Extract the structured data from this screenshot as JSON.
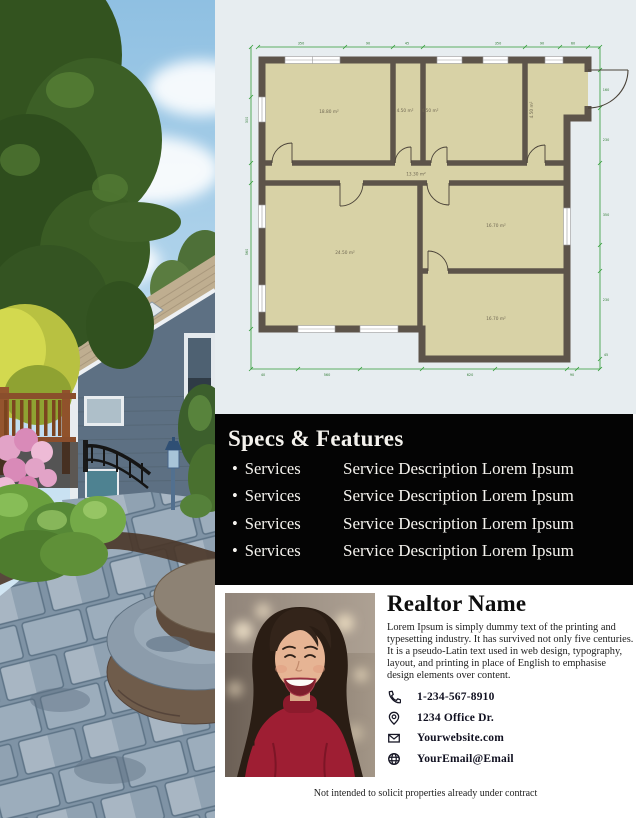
{
  "photo": {
    "description": "house exterior with evergreen tree, blue siding, deck, flower beds and stone paver walkway"
  },
  "floorplan": {
    "rooms": [
      {
        "id": "room-top-left",
        "label": "18.80 m²"
      },
      {
        "id": "room-hall-small",
        "label": "4.50 m²"
      },
      {
        "id": "room-top-middle",
        "label": "4.50 m²"
      },
      {
        "id": "room-entry",
        "label": "4.50 m²"
      },
      {
        "id": "corridor",
        "label": "13.30 m²"
      },
      {
        "id": "room-bottom-left",
        "label": "24.50 m²"
      },
      {
        "id": "room-middle-right",
        "label": "16.70 m²"
      },
      {
        "id": "room-bottom-right",
        "label": "16.70 m²"
      }
    ],
    "dims": {
      "top": [
        "350",
        "90",
        "45",
        "350",
        "90",
        "60"
      ],
      "left": [
        "300",
        "560"
      ],
      "right": [
        "160",
        "230",
        "350",
        "230",
        "45"
      ],
      "bottom": [
        "40",
        "560",
        "620",
        "90"
      ]
    },
    "colors": {
      "wall": "#5d544a",
      "room_fill": "#d8d2a6",
      "dimension_line": "#2f9b35",
      "background": "#e7edf0"
    }
  },
  "specs": {
    "title": "Specs & Features",
    "rows": [
      {
        "bullet": "•",
        "service": "Services",
        "description": "Service Description Lorem Ipsum"
      },
      {
        "bullet": "•",
        "service": "Services",
        "description": "Service Description Lorem Ipsum"
      },
      {
        "bullet": "•",
        "service": "Services",
        "description": "Service Description Lorem Ipsum"
      },
      {
        "bullet": "•",
        "service": "Services",
        "description": "Service Description Lorem Ipsum"
      }
    ],
    "colors": {
      "background": "#040404",
      "text": "#f5f3ee"
    }
  },
  "realtor": {
    "name": "Realtor Name",
    "bio": "Lorem Ipsum is simply dummy text of the printing and typesetting industry. It has survived not only five centuries. It is a pseudo-Latin text used in web design, typography, layout, and printing in place of English to emphasise design elements over content.",
    "contacts": [
      {
        "icon": "phone-icon",
        "value": "1-234-567-8910"
      },
      {
        "icon": "location-pin-icon",
        "value": "1234 Office Dr."
      },
      {
        "icon": "envelope-icon",
        "value": "Yourwebsite.com"
      },
      {
        "icon": "globe-icon",
        "value": "YourEmail@Email"
      }
    ]
  },
  "footer": {
    "disclaimer": "Not intended to solicit properties already under contract"
  }
}
